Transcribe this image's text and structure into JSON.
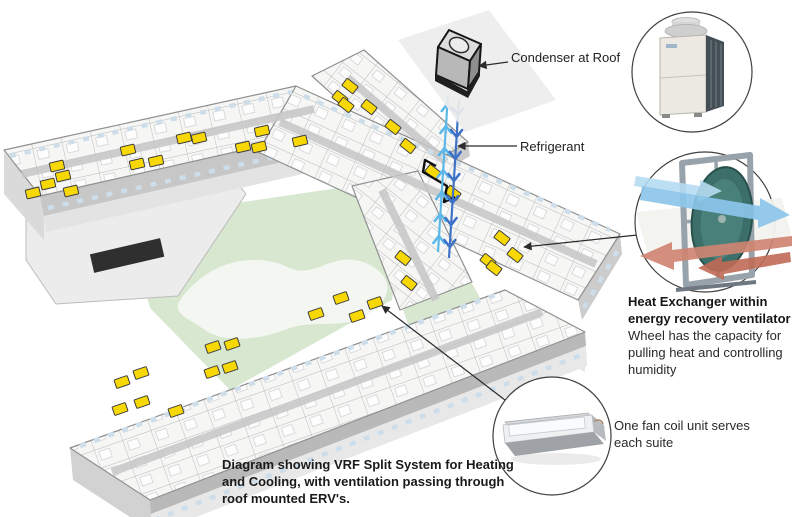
{
  "caption": {
    "lines": [
      "Diagram showing VRF Split System for Heating",
      "and Cooling, with ventilation passing through",
      "roof mounted ERV's."
    ]
  },
  "callouts": {
    "condenser": {
      "label": "Condenser at Roof"
    },
    "refrigerant": {
      "label": "Refrigerant"
    },
    "heat_exchanger": {
      "title_lines": [
        "Heat Exchanger within",
        "energy recovery ventilator"
      ],
      "body_lines": [
        "Wheel has the capacity for",
        "pulling heat and controlling",
        "humidity"
      ]
    },
    "fan_coil": {
      "label_lines": [
        "One fan coil unit serves",
        "each suite"
      ]
    }
  },
  "colors": {
    "refrigerant_supply": "#5cb8e8",
    "refrigerant_return": "#3e72c6",
    "fan_coil_unit": "#f8d804",
    "courtyard_green": "#d8e7d0",
    "erv_fresh_air": "#8cc6ea",
    "erv_exhaust_air": "#cf8472",
    "callout_line": "#2b2b2b",
    "text": "#231f20"
  },
  "building": {
    "fan_coil_units": [
      {
        "x": 33,
        "y": 193,
        "r": -13
      },
      {
        "x": 48,
        "y": 184,
        "r": -13
      },
      {
        "x": 63,
        "y": 176,
        "r": -13
      },
      {
        "x": 71,
        "y": 191,
        "r": -13
      },
      {
        "x": 57,
        "y": 166,
        "r": -13
      },
      {
        "x": 128,
        "y": 150,
        "r": -13
      },
      {
        "x": 137,
        "y": 164,
        "r": -13
      },
      {
        "x": 156,
        "y": 161,
        "r": -13
      },
      {
        "x": 184,
        "y": 138,
        "r": -13
      },
      {
        "x": 199,
        "y": 138,
        "r": -13
      },
      {
        "x": 243,
        "y": 147,
        "r": -13
      },
      {
        "x": 259,
        "y": 147,
        "r": -13
      },
      {
        "x": 262,
        "y": 131,
        "r": -13
      },
      {
        "x": 300,
        "y": 141,
        "r": -13
      },
      {
        "x": 350,
        "y": 86,
        "r": 38
      },
      {
        "x": 340,
        "y": 98,
        "r": 38
      },
      {
        "x": 346,
        "y": 105,
        "r": 38
      },
      {
        "x": 369,
        "y": 107,
        "r": 38
      },
      {
        "x": 393,
        "y": 127,
        "r": 38
      },
      {
        "x": 408,
        "y": 146,
        "r": 38
      },
      {
        "x": 433,
        "y": 172,
        "r": 38
      },
      {
        "x": 453,
        "y": 193,
        "r": 38
      },
      {
        "x": 502,
        "y": 238,
        "r": 38
      },
      {
        "x": 515,
        "y": 255,
        "r": 38
      },
      {
        "x": 488,
        "y": 261,
        "r": 38
      },
      {
        "x": 494,
        "y": 268,
        "r": 38
      },
      {
        "x": 403,
        "y": 258,
        "r": 38
      },
      {
        "x": 409,
        "y": 283,
        "r": 38
      },
      {
        "x": 341,
        "y": 298,
        "r": -19
      },
      {
        "x": 375,
        "y": 303,
        "r": -19
      },
      {
        "x": 316,
        "y": 314,
        "r": -19
      },
      {
        "x": 357,
        "y": 316,
        "r": -19
      },
      {
        "x": 232,
        "y": 344,
        "r": -19
      },
      {
        "x": 213,
        "y": 347,
        "r": -19
      },
      {
        "x": 230,
        "y": 367,
        "r": -19
      },
      {
        "x": 212,
        "y": 372,
        "r": -19
      },
      {
        "x": 141,
        "y": 373,
        "r": -19
      },
      {
        "x": 122,
        "y": 382,
        "r": -19
      },
      {
        "x": 142,
        "y": 402,
        "r": -19
      },
      {
        "x": 120,
        "y": 409,
        "r": -19
      },
      {
        "x": 176,
        "y": 411,
        "r": -19
      }
    ]
  }
}
